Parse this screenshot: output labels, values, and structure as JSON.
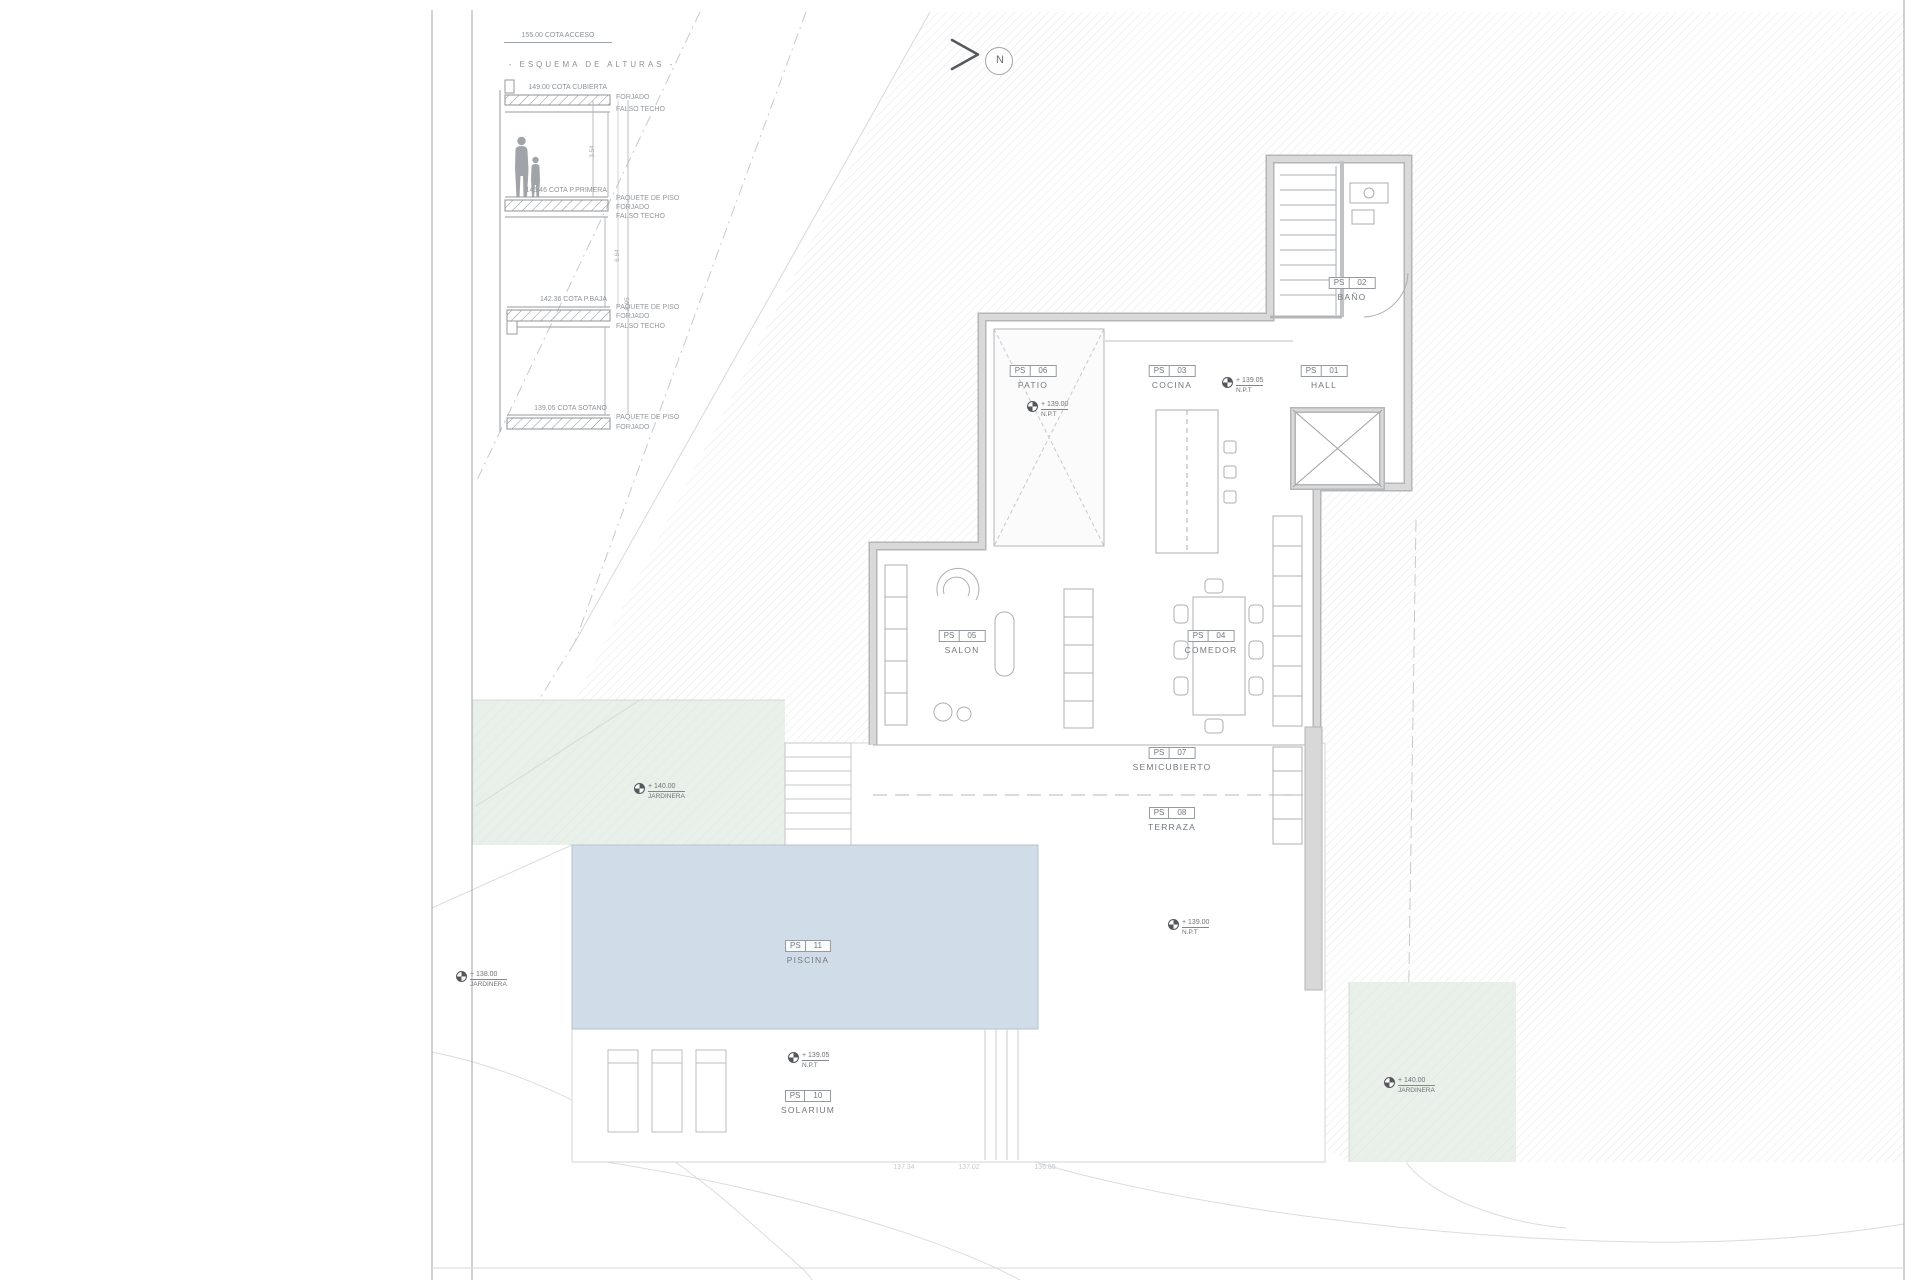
{
  "sheet": {
    "access_label": "155.00 COTA ACCESO",
    "scheme_title": "- ESQUEMA DE ALTURAS -",
    "north_label": "N"
  },
  "scheme_levels": [
    {
      "cota": "149.00 COTA CUBIERTA",
      "layers": [
        "FORJADO",
        "FALSO TECHO"
      ]
    },
    {
      "cota": "145.46 COTA P.PRIMERA",
      "layers": [
        "PAQUETE DE PISO",
        "FORJADO",
        "FALSO TECHO"
      ]
    },
    {
      "cota": "142.36 COTA P.BAJA",
      "layers": [
        "PAQUETE DE PISO",
        "FORJADO",
        "FALSO TECHO"
      ]
    },
    {
      "cota": "139.05 COTA SOTANO",
      "layers": [
        "PAQUETE DE PISO",
        "FORJADO"
      ]
    }
  ],
  "scheme_dims": [
    "3.54",
    "6.64",
    "9.95"
  ],
  "rooms": [
    {
      "code": "PS",
      "num": "06",
      "name": "PATIO"
    },
    {
      "code": "PS",
      "num": "03",
      "name": "COCINA"
    },
    {
      "code": "PS",
      "num": "01",
      "name": "HALL"
    },
    {
      "code": "PS",
      "num": "02",
      "name": "BAÑO"
    },
    {
      "code": "PS",
      "num": "05",
      "name": "SALON"
    },
    {
      "code": "PS",
      "num": "04",
      "name": "COMEDOR"
    },
    {
      "code": "PS",
      "num": "07",
      "name": "SEMICUBIERTO"
    },
    {
      "code": "PS",
      "num": "08",
      "name": "TERRAZA"
    },
    {
      "code": "PS",
      "num": "11",
      "name": "PISCINA"
    },
    {
      "code": "PS",
      "num": "10",
      "name": "SOLARIUM"
    }
  ],
  "markers": {
    "patio": {
      "value": "+ 139.00",
      "sub": "N.P.T"
    },
    "cocina": {
      "value": "+ 139.05",
      "sub": "N.P.T"
    },
    "terraza": {
      "value": "+ 139.00",
      "sub": "N.P.T"
    },
    "solarium": {
      "value": "+ 139.05",
      "sub": "N.P.T"
    },
    "jardinera_left": {
      "value": "+ 140.00",
      "sub": "JARDINERA"
    },
    "jardinera_far_left": {
      "value": "+ 138.00",
      "sub": "JARDINERA"
    },
    "jardinera_right": {
      "value": "+ 140.00",
      "sub": "JARDINERA"
    }
  },
  "contour_labels": [
    "137.34",
    "137.02",
    "136.85"
  ],
  "colors": {
    "pool": "#d0dde8",
    "planter_green": "#e9efe9",
    "wall_gray": "#d8d8d8",
    "site_hatch": "#e3e4e7",
    "ink": "#7b7f83"
  }
}
